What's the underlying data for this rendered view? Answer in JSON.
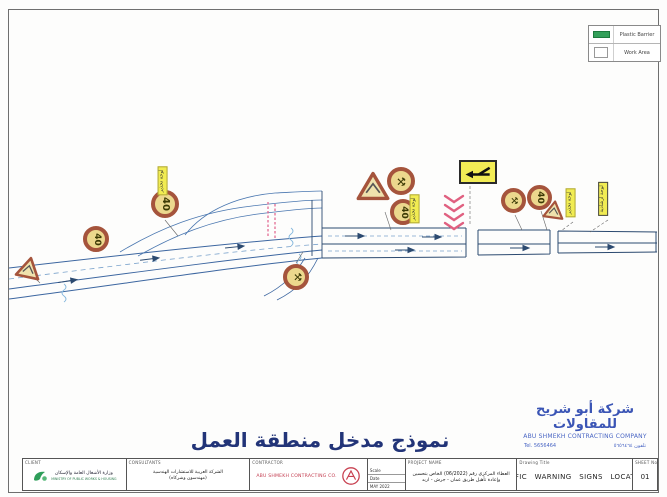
{
  "legend": {
    "items": [
      {
        "label": "Plastic Barrier",
        "color": "#33a05a"
      },
      {
        "label": "Work Area",
        "color": "#ffffff"
      }
    ]
  },
  "diagram": {
    "title_ar": "نموذج مدخل منطقة العمل",
    "speed_limit": "40",
    "work_glyph": "⚒",
    "tags": {
      "ramp": "لوحة تحذير",
      "entry": "لوحة تحذير",
      "end1": "لوحة تحذير",
      "end2": "لوحة ارشادية"
    },
    "colors": {
      "sign_ring": "#a5543c",
      "sign_face": "#ecd88d",
      "road_line": "#3c66a0",
      "barrier_pink": "#e06080",
      "legend_green": "#33a05a"
    }
  },
  "stamp": {
    "company_ar": "شركة أبو شريح للمقاولات",
    "company_en": "ABU SHMEKH CONTRACTING COMPANY",
    "tel_en": "Tel. 5656464",
    "tel_ar": "تلفون ٥٦٥٦٤٦٤"
  },
  "title_block": {
    "client_label": "CLIENT",
    "client_ar": "وزارة الأشغال العامة والإسكان",
    "client_en": "MINISTRY OF PUBLIC WORKS & HOUSING",
    "consultants_label": "CONSULTANTS",
    "consultants_line1": "الشركة العربية للاستشارات الهندسية",
    "consultants_line2": "(مهندسون وشركاه)",
    "contractor_label": "CONTRACTOR",
    "contractor_name": "ABU SHMEKH CONTRACTING CO.",
    "scale_label": "Scale",
    "date_label": "Date",
    "date_value": "MAY 2022",
    "project_label": "PROJECT NAME",
    "project_line1": "العطاء المركزي رقم (06/2022) الخاص بتحسين",
    "project_line2": "وإعادة تأهيل طريق عمان - جرش - اربد",
    "drawing_title_label": "Drawing Title",
    "drawing_title": "TRAFFIC WARNING SIGNS LOCATIONS",
    "sheet_label": "SHEET No.",
    "sheet_value": "01"
  }
}
